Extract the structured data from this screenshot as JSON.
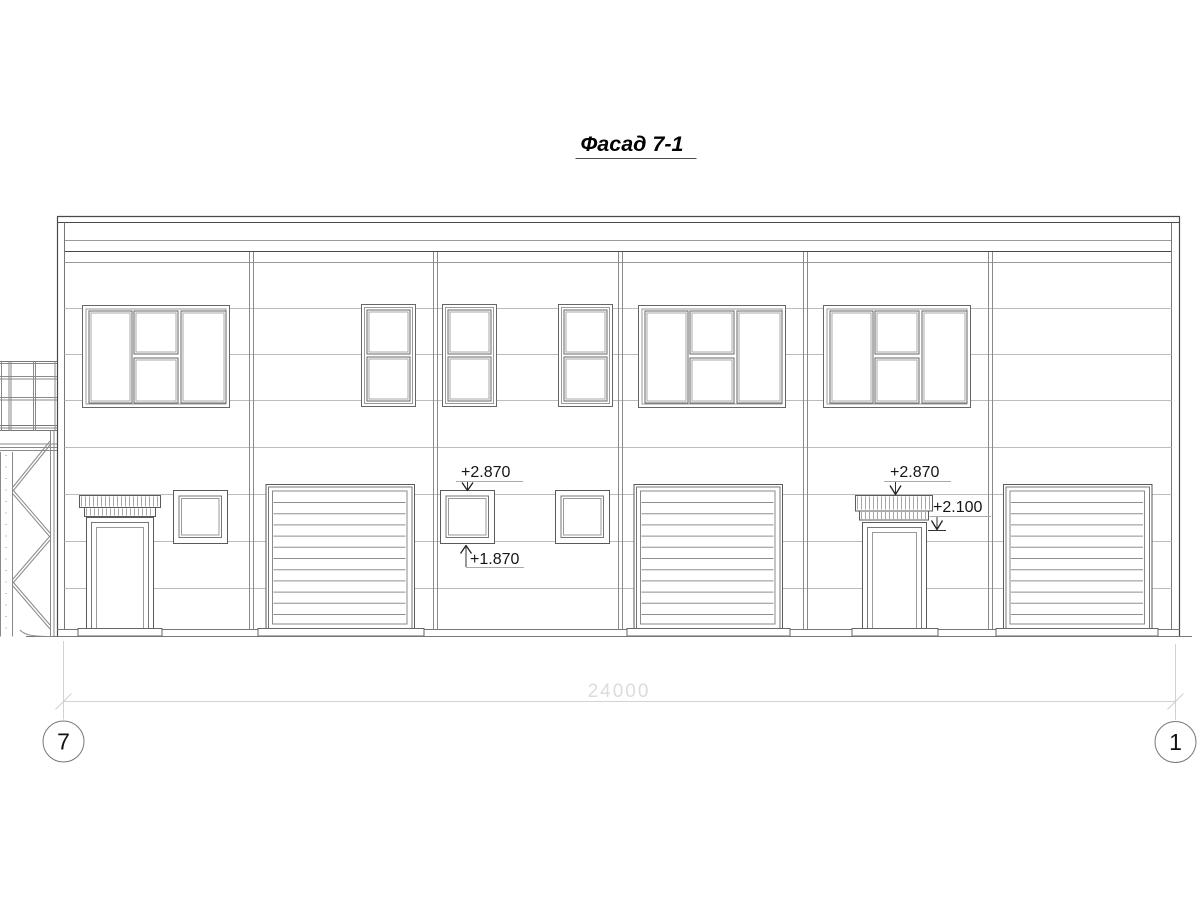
{
  "drawing_title": "Фасад 7-1",
  "elevation_marks": {
    "window_head": "+2.870",
    "window_sill": "+1.870",
    "canopy_top": "+2.870",
    "canopy_underside": "+2.100"
  },
  "dimensions": {
    "overall": "24000"
  },
  "axes": {
    "left_bubble": "7",
    "right_bubble": "1"
  },
  "colors": {
    "background": "#ffffff",
    "line_dark": "#4a4a4a",
    "line_medium": "#777777",
    "line_light": "#bcbcbc",
    "dimension_line": "#d2d2d2",
    "dimension_text": "#dcdcdc",
    "annotation_text": "#151515"
  }
}
